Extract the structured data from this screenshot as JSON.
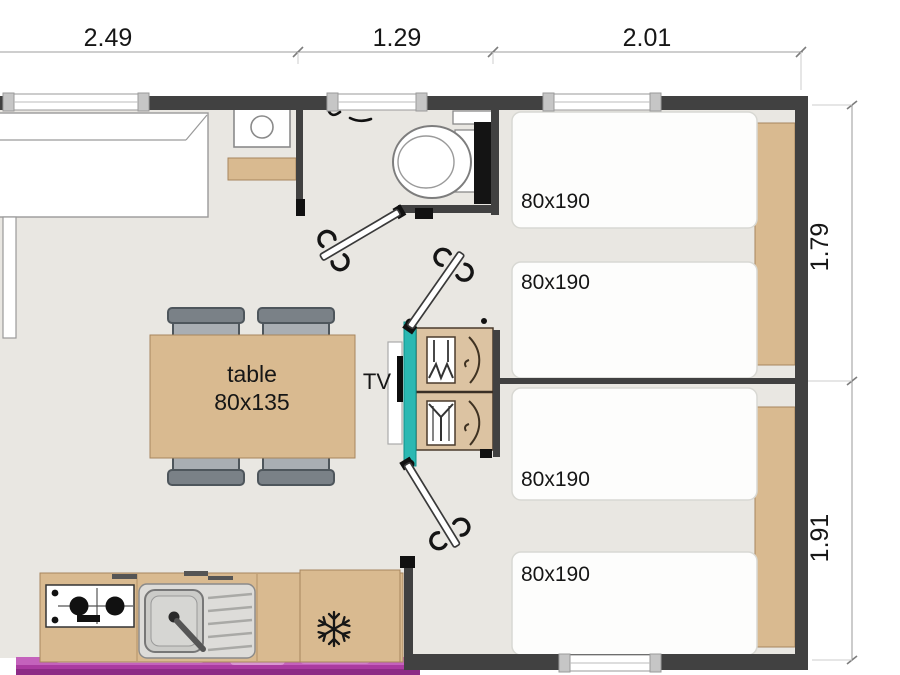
{
  "plan_title": "mobile-home floor plan",
  "dimensions": {
    "top": [
      "2.49",
      "1.29",
      "2.01"
    ],
    "right": [
      "1.79",
      "1.91"
    ]
  },
  "living_area": {
    "table_label": "table",
    "table_size": "80x135",
    "tv_label": "TV"
  },
  "bedrooms": {
    "bed_labels": [
      "80x190",
      "80x190",
      "80x190",
      "80x190"
    ]
  },
  "icons": {
    "freezer": "snowflake-icon",
    "stove": "gas-burners-icon",
    "sink": "sink-basin-icon",
    "toilet": "toilet-icon",
    "wardrobe": "hanging-clothes-icon",
    "doors": "door-swing-icon"
  },
  "colors": {
    "wall": "#414141",
    "floor": "#e9e7e2",
    "wood": "#d9ba90",
    "wood_light": "#dcc3a2",
    "teal_partition": "#2bb8b2",
    "deck_pink": "#aa3ba0",
    "deck_pink_light": "#d995d2",
    "chair_seat": "#a9aeb3",
    "chair_back": "#7a8187",
    "bed_fill": "#fdfdfc",
    "dimension_line": "#b0b0b0",
    "text": "#161616"
  }
}
